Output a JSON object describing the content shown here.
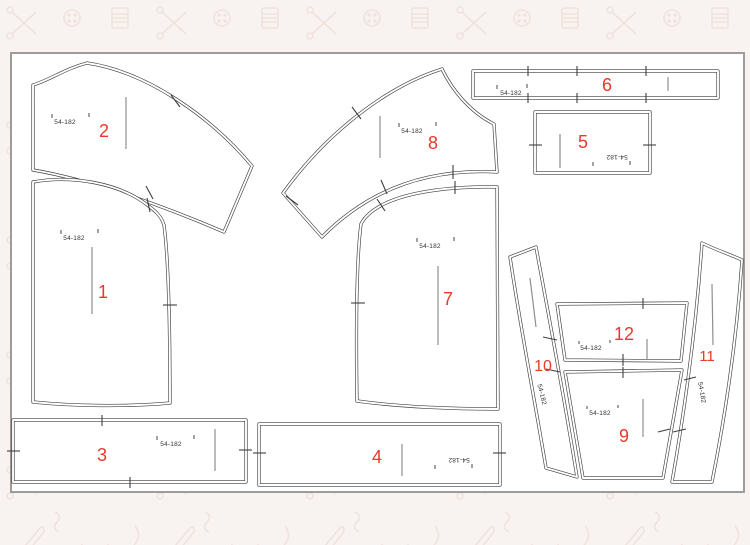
{
  "document": {
    "kind": "sewing-pattern-cutting-layout"
  },
  "colors": {
    "page_background": "#f8f3f1",
    "doodle": "#f0e2dd",
    "canvas_fill": "#ffffff",
    "canvas_border": "#9c9c9c",
    "piece_outline": "#3f3f3f",
    "grain_line": "#8f8f8f",
    "number_red": "#e8392b",
    "size_text": "#333333"
  },
  "background_icons": [
    "scissors-icon",
    "button-icon",
    "thread-spool-icon",
    "safety-pin-icon",
    "bow-icon",
    "thread-squiggle-icon"
  ],
  "pieces": {
    "p1": {
      "number": "1",
      "size": "54-182"
    },
    "p2": {
      "number": "2",
      "size": "54-182"
    },
    "p3": {
      "number": "3",
      "size": "54-182"
    },
    "p4": {
      "number": "4",
      "size": "54-182"
    },
    "p5": {
      "number": "5",
      "size": "54-182"
    },
    "p6": {
      "number": "6",
      "size": "54-182"
    },
    "p7": {
      "number": "7",
      "size": "54-182"
    },
    "p8": {
      "number": "8",
      "size": "54-182"
    },
    "p9": {
      "number": "9",
      "size": "54-182"
    },
    "p10": {
      "number": "10",
      "size": "54-182"
    },
    "p11": {
      "number": "11",
      "size": "54-182"
    },
    "p12": {
      "number": "12",
      "size": "54-182"
    }
  }
}
